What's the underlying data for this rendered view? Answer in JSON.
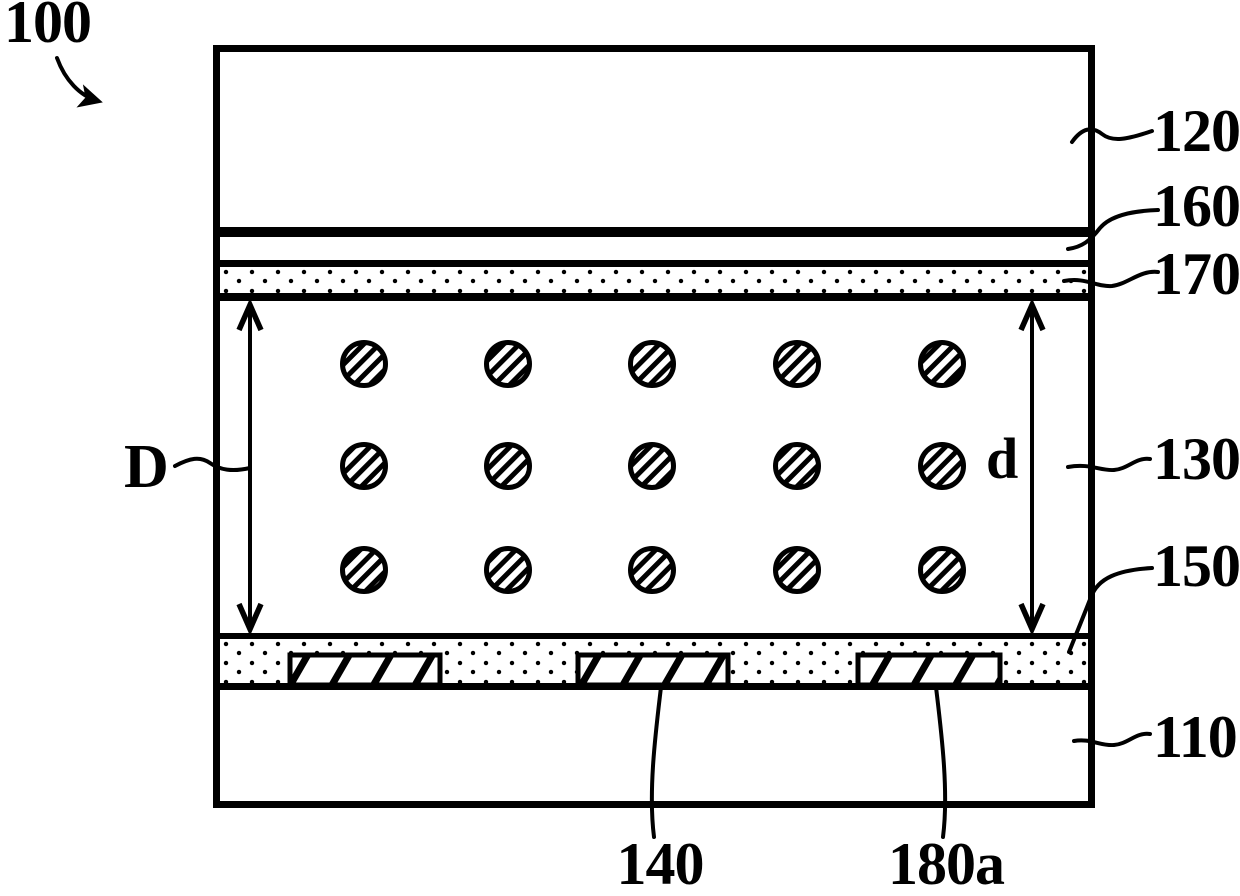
{
  "figure_label": "100",
  "dimension_markers": {
    "left": "D",
    "right": "d"
  },
  "reference_labels": {
    "ref_120": "120",
    "ref_160": "160",
    "ref_170": "170",
    "ref_130": "130",
    "ref_150": "150",
    "ref_110": "110",
    "ref_140": "140",
    "ref_180a": "180a"
  },
  "colors": {
    "ink": "#000000",
    "paper": "#ffffff"
  },
  "icons": {
    "curved_pointer": "figure-number-arrow",
    "double_headed_arrow_left": "dimension-arrow-D",
    "double_headed_arrow_right": "dimension-arrow-d"
  },
  "diagram": {
    "particles": {
      "row_centers_y": [
        364,
        466,
        570
      ],
      "col_centers_x": [
        364,
        508,
        652,
        797,
        942
      ],
      "radius": 21.5
    },
    "electrodes": [
      {
        "x": 290,
        "y": 655,
        "w": 150,
        "h": 30
      },
      {
        "x": 578,
        "y": 655,
        "w": 150,
        "h": 30
      },
      {
        "x": 858,
        "y": 655,
        "w": 142,
        "h": 30
      }
    ]
  }
}
